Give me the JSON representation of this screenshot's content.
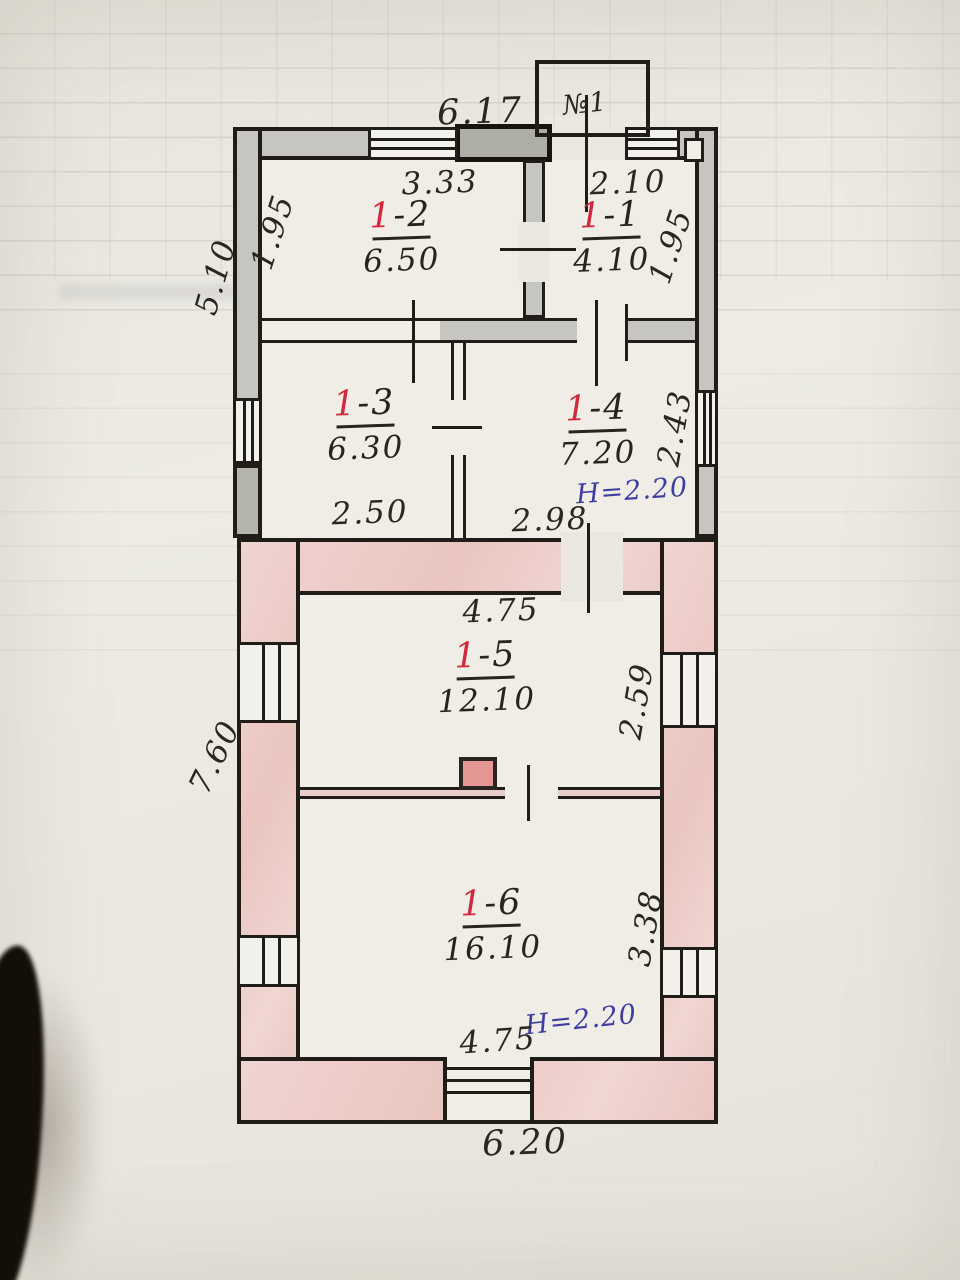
{
  "porch": {
    "label": "№1"
  },
  "rooms": [
    {
      "prefix": "1",
      "suffix": "-1",
      "area": "4.10"
    },
    {
      "prefix": "1",
      "suffix": "-2",
      "area": "6.50"
    },
    {
      "prefix": "1",
      "suffix": "-3",
      "area": "6.30"
    },
    {
      "prefix": "1",
      "suffix": "-4",
      "area": "7.20"
    },
    {
      "prefix": "1",
      "suffix": "-5",
      "area": "12.10"
    },
    {
      "prefix": "1",
      "suffix": "-6",
      "area": "16.10"
    }
  ],
  "dims": {
    "overall_top": "6.17",
    "room2_width": "3.33",
    "room1_width": "2.10",
    "room2_left": "1.95",
    "room1_right": "1.95",
    "upper_left_height": "5.10",
    "room3_width": "2.50",
    "room4_width": "2.98",
    "room4_right": "2.43",
    "room5_width": "4.75",
    "room5_right": "2.59",
    "lower_left_height": "7.60",
    "room6_right": "3.38",
    "room6_width": "4.75",
    "overall_bottom": "6.20"
  },
  "notes": {
    "ceiling_height_upper": "H=2.20",
    "ceiling_height_lower": "H=2.20"
  },
  "colors": {
    "line": "#201d18",
    "wall_gray": "#c6c5bf",
    "wall_pink": "#eed1cd",
    "room_number_red": "#d22a3c",
    "note_blue": "#3f3da0",
    "stove_red": "#e59795",
    "paper": "#eae7e0"
  }
}
